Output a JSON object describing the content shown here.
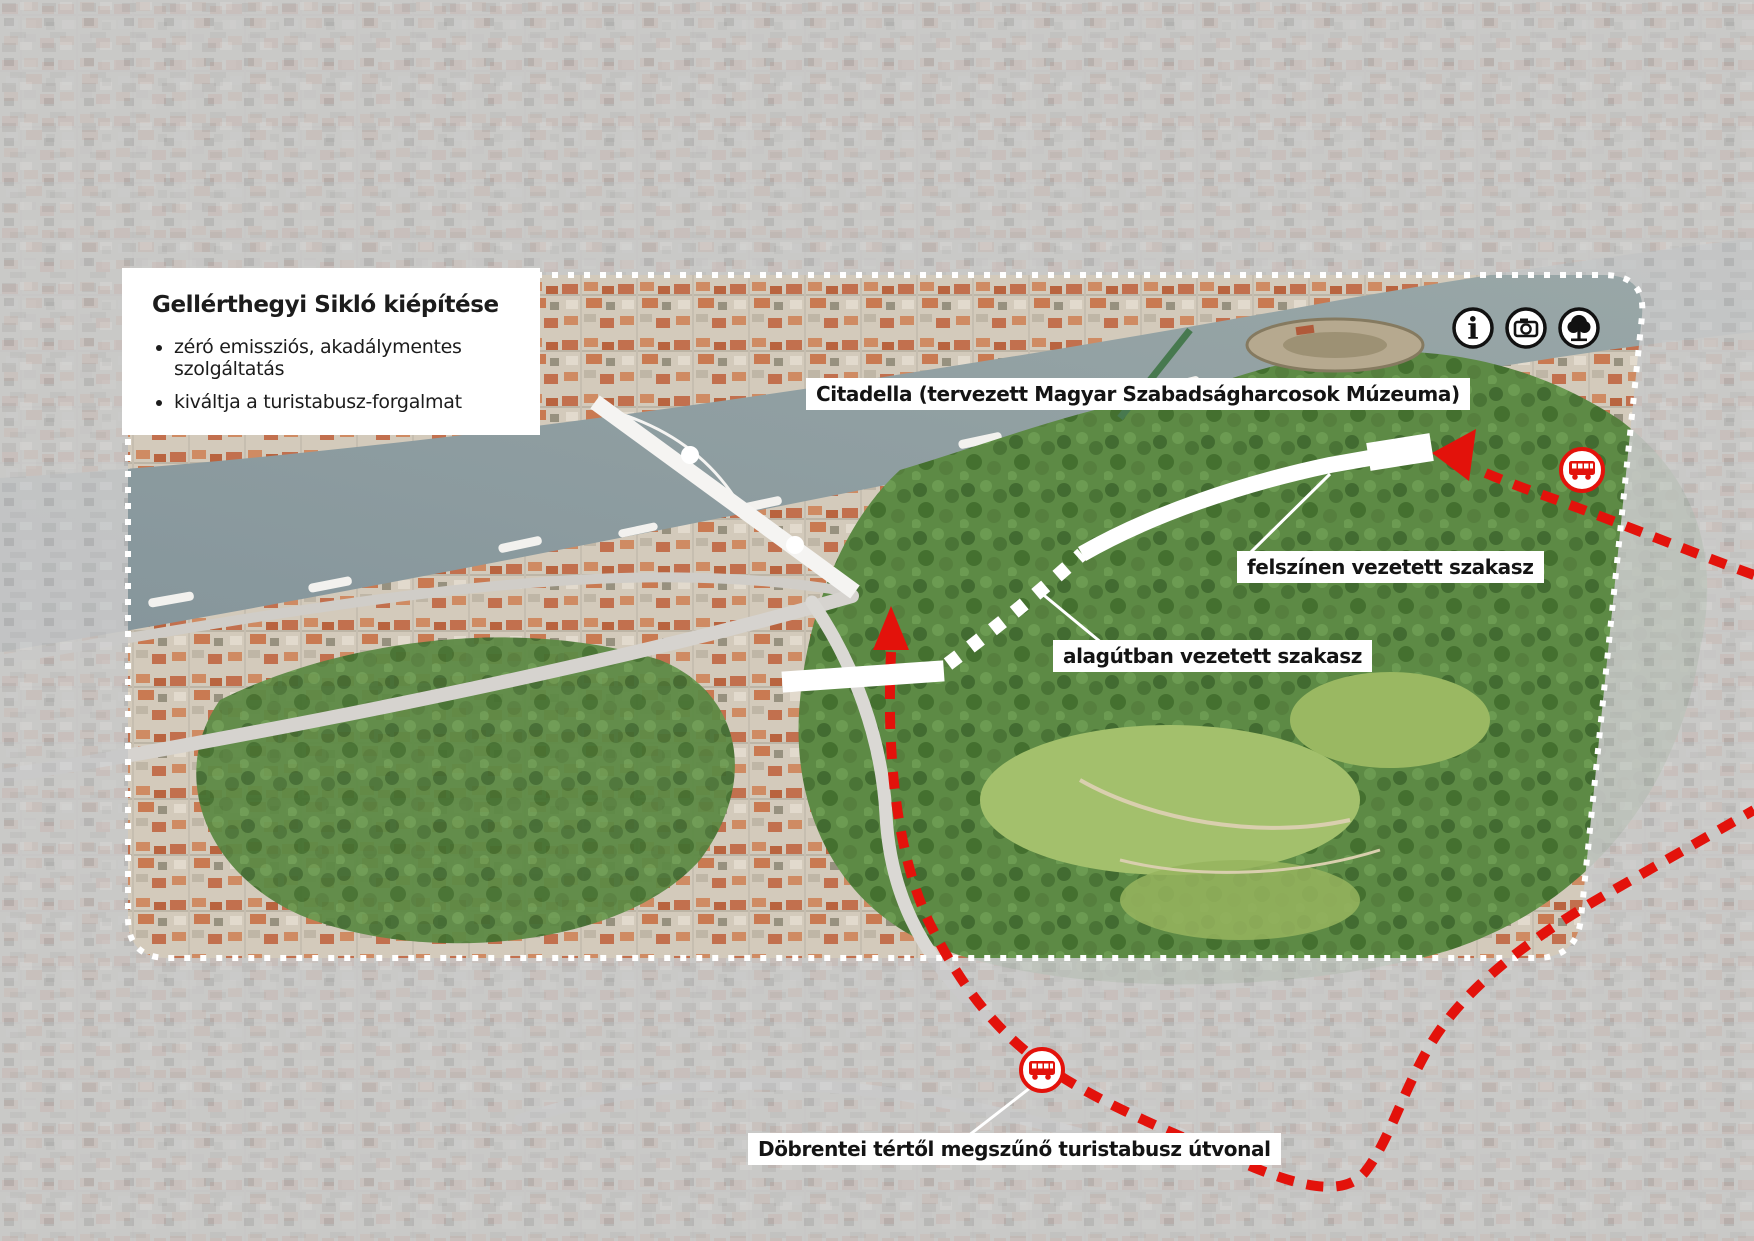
{
  "info_box": {
    "title": "Gellérthegyi Sikló kiépítése",
    "bullets": [
      "zéró emissziós, akadálymentes szolgáltatás",
      "kiváltja a turistabusz-forgalmat"
    ]
  },
  "map_labels": {
    "citadella": "Citadella (tervezett Magyar Szabadságharcosok Múzeuma)",
    "surface_section": "felszínen vezetett szakasz",
    "tunnel_section": "alagútban vezetett szakasz",
    "bus_route": "Döbrentei tértől megszűnő turistabusz útvonal"
  },
  "legend_icons": [
    {
      "name": "info-icon",
      "glyph": "i"
    },
    {
      "name": "camera-icon"
    },
    {
      "name": "tree-icon"
    }
  ],
  "markers": {
    "bus_stop_upper": "bus-icon",
    "bus_stop_lower": "bus-icon"
  },
  "routes": [
    {
      "id": "funicular-surface",
      "label": "felszínen vezetett szakasz",
      "style": "solid-white"
    },
    {
      "id": "funicular-tunnel",
      "label": "alagútban vezetett szakasz",
      "style": "dotted-white"
    },
    {
      "id": "tourist-bus",
      "label": "Döbrentei tértől megszűnő turistabusz útvonal",
      "style": "dashed-red"
    }
  ],
  "colors": {
    "route_red": "#e3120b",
    "annotation_white": "#ffffff",
    "label_bg": "#ffffff",
    "label_text": "#141414"
  }
}
